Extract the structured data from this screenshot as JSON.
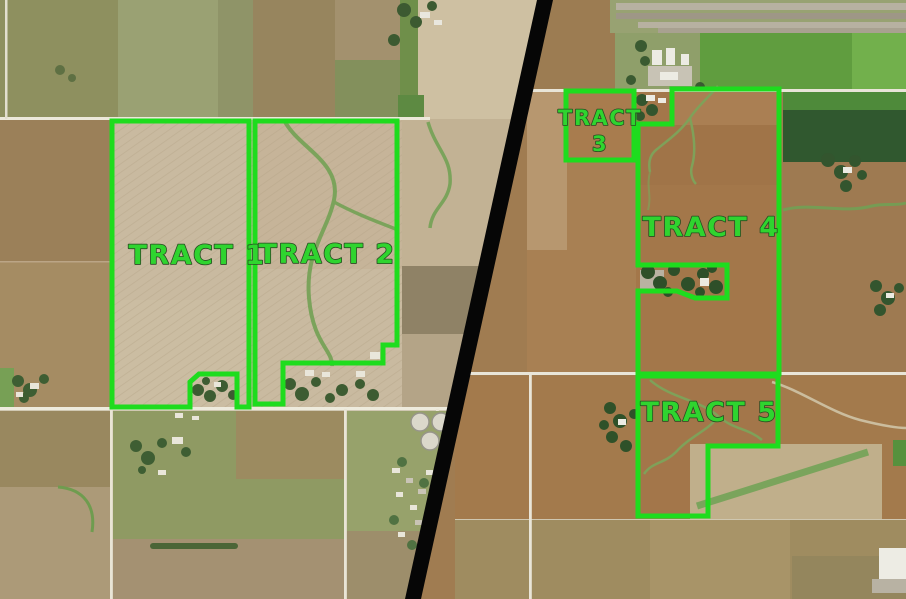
{
  "map": {
    "type": "split-aerial-tract-map",
    "left_panel_tracts": [
      "TRACT 1",
      "TRACT 2"
    ],
    "right_panel_tracts": [
      "TRACT 3",
      "TRACT 4",
      "TRACT 5"
    ]
  },
  "tracts": {
    "t1": {
      "label": "TRACT 1",
      "points": "112,121 249,121 249,407 237,407 237,374 199,374 190,382 190,407 112,407"
    },
    "t2": {
      "label": "TRACT 2",
      "points": "255,121 397,121 397,345 383,345 383,363 283,363 283,404 255,404"
    },
    "t3": {
      "label_line1": "TRACT",
      "label_line2": "3",
      "points": "566,91 634,91 634,160 566,160"
    },
    "t4": {
      "label": "TRACT 4",
      "points": "672,89 779,89 779,374 638,374 638,291 677,291 695,298 727,298 727,265 638,265 638,124 672,124"
    },
    "t5": {
      "label": "TRACT 5",
      "points": "638,376 778,376 778,446 708,446 708,516 638,516"
    }
  },
  "divider": {
    "points": "537,0 553,0 421,599 405,599"
  },
  "colors": {
    "tract_outline": "#1edc1e",
    "tract_label": "#2fd42f",
    "label_outline": "#2a4a22",
    "divider": "#060606"
  }
}
